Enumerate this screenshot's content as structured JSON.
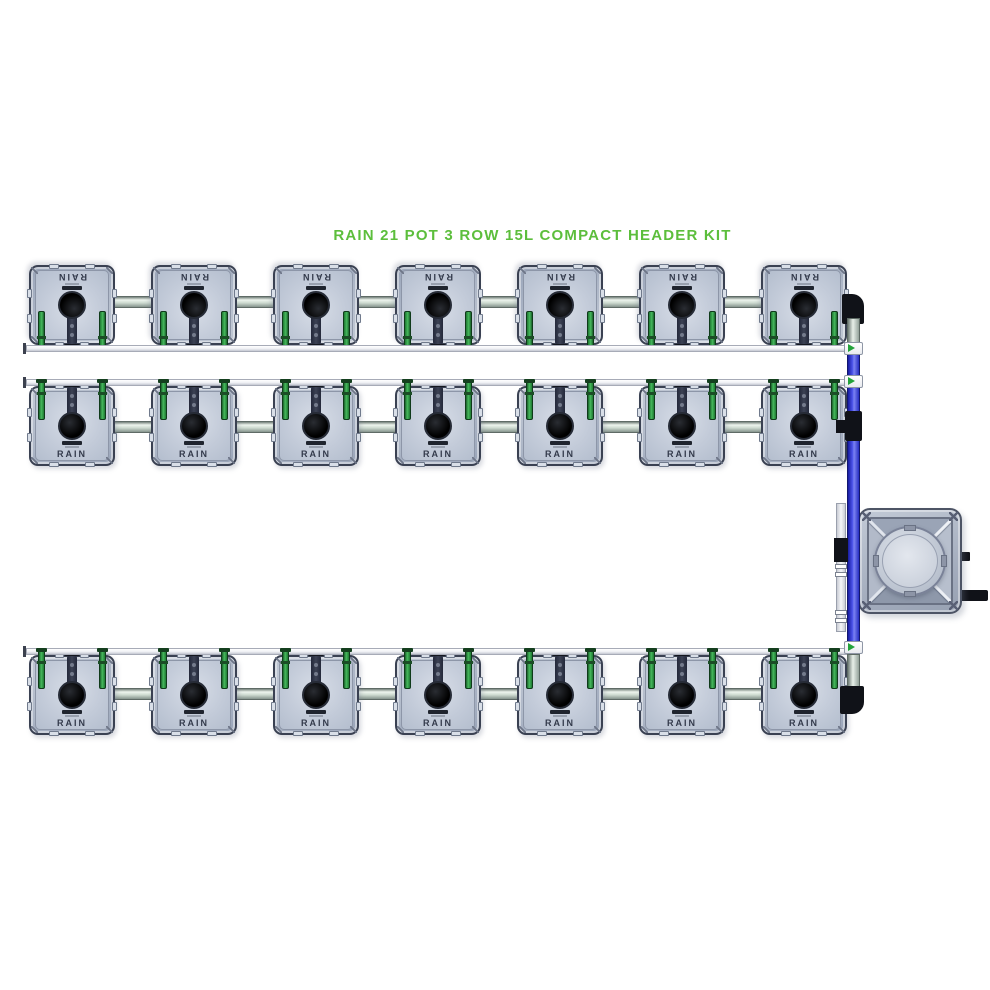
{
  "title": {
    "text": "RAIN 21 POT 3 ROW 15L COMPACT HEADER KIT",
    "color": "#5cbe3c"
  },
  "system": {
    "pot_label": "RAIN",
    "pot_count": 21,
    "pot_size": "15L",
    "rows": [
      {
        "name": "row-1",
        "pots": 7,
        "orientation": "down"
      },
      {
        "name": "row-2",
        "pots": 7,
        "orientation": "up"
      },
      {
        "name": "row-3",
        "pots": 7,
        "orientation": "up"
      }
    ],
    "header_tank": {
      "position": "right",
      "ports": [
        "small-barb",
        "large-barb"
      ]
    },
    "flow_arrows": 3,
    "colors": {
      "title_green": "#5cbe3c",
      "pot_body": "#b9c3d3",
      "pot_edge": "#3a4152",
      "grommet_green": "#2f9e47",
      "feed_pipe_gray": "#ccd9cf",
      "return_pipe_white": "#f2f3f6",
      "manifold_blue": "#4a52e8",
      "fitting_black": "#101218",
      "tank_gray": "#aab3c2",
      "arrow_green": "#23a23a",
      "background": "#ffffff"
    }
  }
}
